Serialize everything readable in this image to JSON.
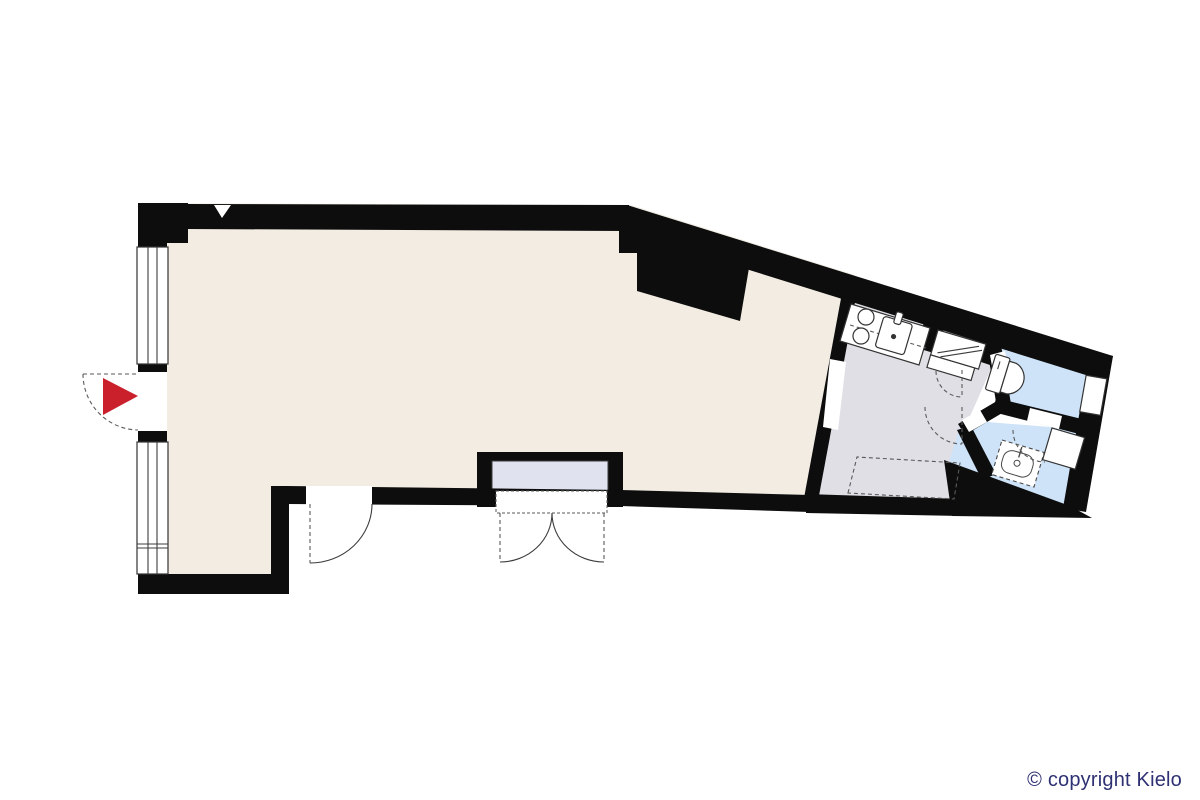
{
  "copyright": {
    "label": "© copyright Kielo",
    "color": "#2e3173"
  },
  "colors": {
    "background": "#ffffff",
    "walls": "#0d0d0d",
    "room_main": "#f2ece3",
    "room_kitchen": "#e0dfe6",
    "room_bath": "#cee3f8",
    "vestibule": "#e0e2f0",
    "entrance_arrow": "#c9202c",
    "fixture_line": "#333333"
  },
  "rooms": [
    {
      "name": "main-room",
      "fill": "#f2ece3"
    },
    {
      "name": "kitchen",
      "fill": "#e0dfe6"
    },
    {
      "name": "toilet-room",
      "fill": "#cee3f8"
    },
    {
      "name": "shower-room",
      "fill": "#cee3f8"
    },
    {
      "name": "entrance-vestibule",
      "fill": "#e0e2f0"
    }
  ],
  "fixtures": [
    "window",
    "window",
    "entrance-door",
    "cooktop-burners",
    "kitchen-sink",
    "utility-closet",
    "toilet",
    "washbasin-dashed",
    "appliance-dashed",
    "washer",
    "double-door",
    "single-door"
  ],
  "markers": {
    "entrance_arrow": "entrance-direction-right"
  }
}
